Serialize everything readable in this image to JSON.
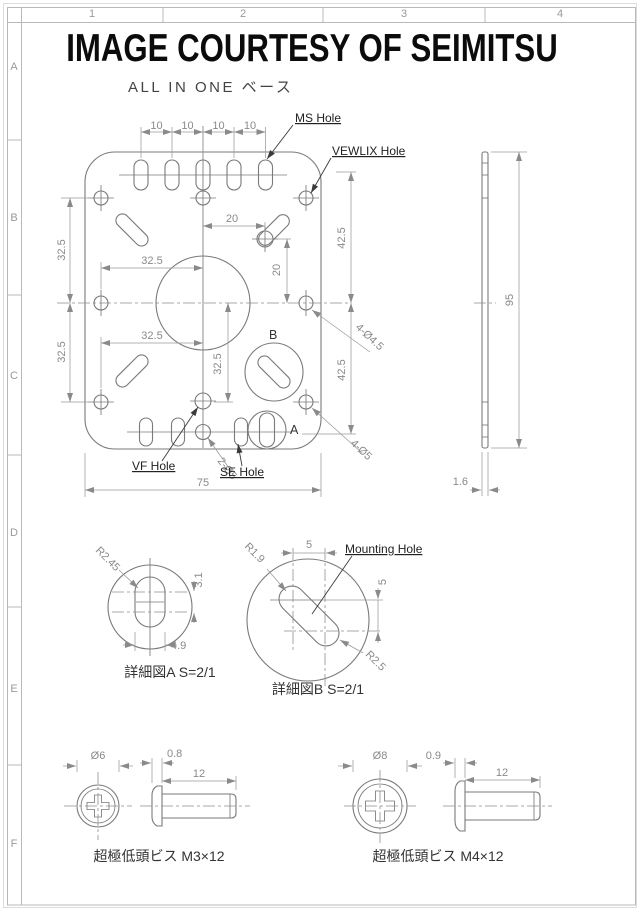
{
  "header": {
    "title": "IMAGE COURTESY OF SEIMITSU",
    "subtitle": "ALL IN ONE ベース"
  },
  "grid": {
    "cols": [
      "1",
      "2",
      "3",
      "4"
    ],
    "rows": [
      "A",
      "B",
      "C",
      "D",
      "E",
      "F"
    ]
  },
  "main": {
    "labels": {
      "ms": "MS Hole",
      "vewlix": "VEWLIX Hole",
      "vf": "VF Hole",
      "se": "SE Hole",
      "detail_a": "A",
      "detail_b": "B"
    },
    "dims": {
      "pitch": [
        "10",
        "10",
        "10",
        "10"
      ],
      "h20": "20",
      "v20": "20",
      "left_top": "32.5",
      "left_bottom": "32.5",
      "h_top": "32.5",
      "h_bottom": "32.5",
      "v_center": "32.5",
      "right_top": "42.5",
      "right_bottom": "42.5",
      "width": "75",
      "holes_small": "4-Ø4.5",
      "holes_large": "4-Ø5",
      "holes_pair": "2-Ø5"
    }
  },
  "side": {
    "height": "95",
    "thickness": "1.6"
  },
  "detail_a": {
    "caption": "詳細図A S=2/1",
    "radius": "R2.45",
    "length": "3.1",
    "width": "4.9"
  },
  "detail_b": {
    "caption": "詳細図B S=2/1",
    "label": "Mounting Hole",
    "r_small": "R1.9",
    "r_large": "R2.5",
    "dx": "5",
    "dy": "5"
  },
  "screw_m3": {
    "dia": "Ø6",
    "head": "0.8",
    "length": "12",
    "caption": "超極低頭ビス M3×12"
  },
  "screw_m4": {
    "dia": "Ø8",
    "head": "0.9",
    "length": "12",
    "caption": "超極低頭ビス M4×12"
  }
}
